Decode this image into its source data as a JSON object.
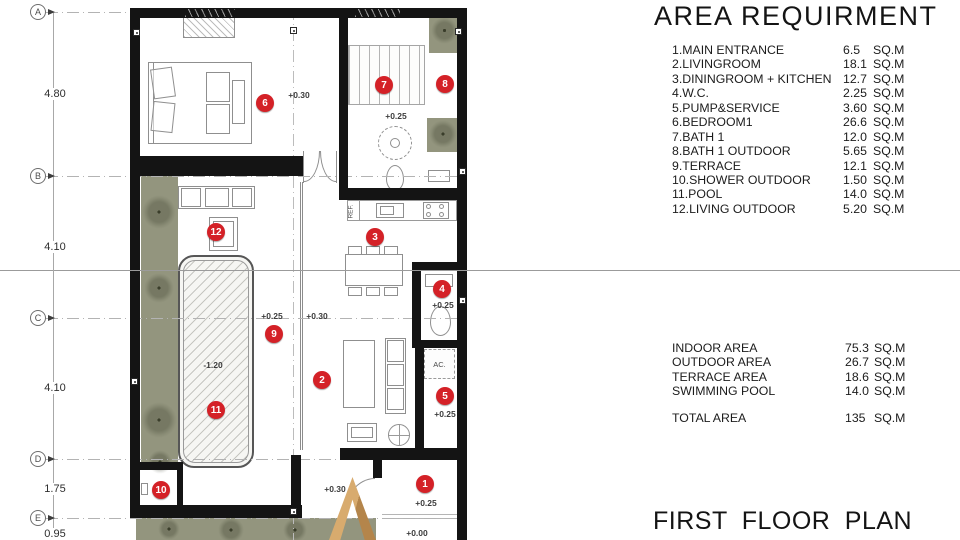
{
  "title": "AREA REQUIRMENT",
  "footer_title": "FIRST FLOOR PLAN",
  "area_items": [
    {
      "label": "1.MAIN ENTRANCE",
      "value": "6.5",
      "unit": "SQ.M"
    },
    {
      "label": "2.LIVINGROOM",
      "value": "18.1",
      "unit": "SQ.M"
    },
    {
      "label": "3.DININGROOM + KITCHEN",
      "value": "12.7",
      "unit": "SQ.M"
    },
    {
      "label": "4.W.C.",
      "value": "2.25",
      "unit": "SQ.M"
    },
    {
      "label": "5.PUMP&SERVICE",
      "value": "3.60",
      "unit": "SQ.M"
    },
    {
      "label": "6.BEDROOM1",
      "value": "26.6",
      "unit": "SQ.M"
    },
    {
      "label": "7.BATH 1",
      "value": "12.0",
      "unit": "SQ.M"
    },
    {
      "label": "8.BATH 1 OUTDOOR",
      "value": "5.65",
      "unit": "SQ.M"
    },
    {
      "label": "9.TERRACE",
      "value": "12.1",
      "unit": "SQ.M"
    },
    {
      "label": "10.SHOWER OUTDOOR",
      "value": "1.50",
      "unit": "SQ.M"
    },
    {
      "label": "11.POOL",
      "value": "14.0",
      "unit": "SQ.M"
    },
    {
      "label": "12.LIVING OUTDOOR",
      "value": "5.20",
      "unit": "SQ.M"
    }
  ],
  "summary_items": [
    {
      "label": "INDOOR AREA",
      "value": "75.3",
      "unit": "SQ.M"
    },
    {
      "label": "OUTDOOR AREA",
      "value": "26.7",
      "unit": "SQ.M"
    },
    {
      "label": "TERRACE AREA",
      "value": "18.6",
      "unit": "SQ.M"
    },
    {
      "label": "SWIMMING POOL",
      "value": "14.0",
      "unit": "SQ.M"
    }
  ],
  "total": {
    "label": "TOTAL AREA",
    "value": "135",
    "unit": "SQ.M"
  },
  "plan": {
    "grid_rows": [
      {
        "label": "A",
        "y": 12
      },
      {
        "label": "B",
        "y": 176
      },
      {
        "label": "C",
        "y": 318
      },
      {
        "label": "D",
        "y": 459
      },
      {
        "label": "E",
        "y": 518
      }
    ],
    "dimensions": [
      {
        "label": "4.80",
        "y": 94
      },
      {
        "label": "4.10",
        "y": 247
      },
      {
        "label": "4.10",
        "y": 388
      },
      {
        "label": "1.75",
        "y": 489
      },
      {
        "label": "0.95",
        "y": 534
      }
    ],
    "markers": [
      {
        "n": "1",
        "x": 425,
        "y": 484
      },
      {
        "n": "2",
        "x": 322,
        "y": 380
      },
      {
        "n": "3",
        "x": 375,
        "y": 237
      },
      {
        "n": "4",
        "x": 442,
        "y": 289
      },
      {
        "n": "5",
        "x": 445,
        "y": 396
      },
      {
        "n": "6",
        "x": 265,
        "y": 103
      },
      {
        "n": "7",
        "x": 384,
        "y": 85
      },
      {
        "n": "8",
        "x": 445,
        "y": 84
      },
      {
        "n": "9",
        "x": 274,
        "y": 334
      },
      {
        "n": "10",
        "x": 161,
        "y": 490
      },
      {
        "n": "11",
        "x": 216,
        "y": 410
      },
      {
        "n": "12",
        "x": 216,
        "y": 232
      }
    ],
    "level_labels": [
      {
        "text": "+0.30",
        "x": 299,
        "y": 95
      },
      {
        "text": "+0.25",
        "x": 396,
        "y": 116
      },
      {
        "text": "+0.25",
        "x": 272,
        "y": 316
      },
      {
        "text": "+0.30",
        "x": 317,
        "y": 316
      },
      {
        "text": "+0.25",
        "x": 443,
        "y": 305
      },
      {
        "text": "-1.20",
        "x": 213,
        "y": 365
      },
      {
        "text": "+0.25",
        "x": 445,
        "y": 414
      },
      {
        "text": "+0.30",
        "x": 335,
        "y": 489
      },
      {
        "text": "+0.25",
        "x": 426,
        "y": 503
      },
      {
        "text": "+0.00",
        "x": 417,
        "y": 533
      }
    ],
    "room_labels": {
      "ref": "REF.",
      "ac": "AC."
    }
  },
  "colors": {
    "marker_red": "#d42127",
    "wall_black": "#141414",
    "planting_green": "#93957e",
    "arrow_gold": "#c89a5f"
  }
}
